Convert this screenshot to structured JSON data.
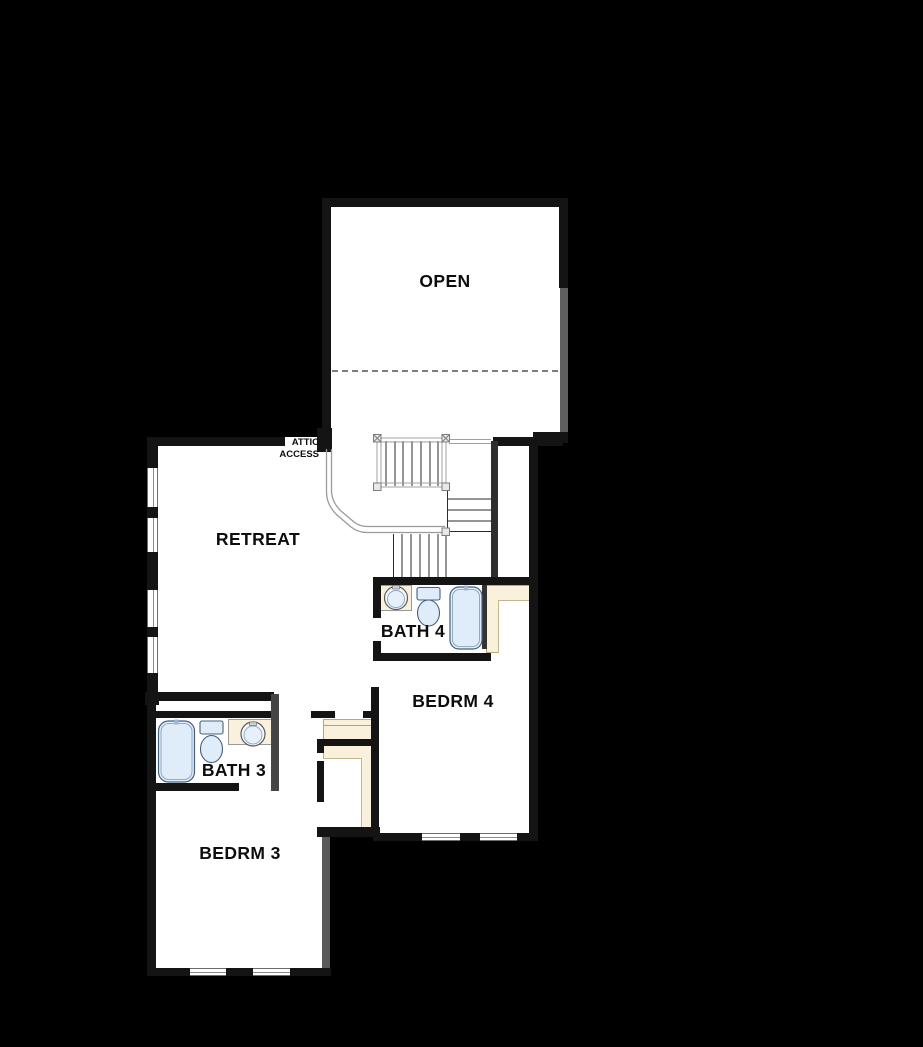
{
  "title": "Second Floor Plan",
  "rooms": {
    "open": "OPEN",
    "retreat": "RETREAT",
    "bath4": "BATH 4",
    "bedrm4": "BEDRM 4",
    "bath3": "BATH 3",
    "bedrm3": "BEDRM 3"
  },
  "annotations": {
    "attic_line1": "ATTIC",
    "attic_line2": "ACCESS"
  },
  "colors": {
    "background": "#000000",
    "floor": "#ffffff",
    "wall": "#141414",
    "wall_gray": "#5f5f5f",
    "closet_tan": "#faf1dd",
    "fixture_blue": "#dfecf9",
    "fixture_outline": "#44607e",
    "railing_gray": "#a0a0a0",
    "tread_dark": "#2b2b2b"
  }
}
